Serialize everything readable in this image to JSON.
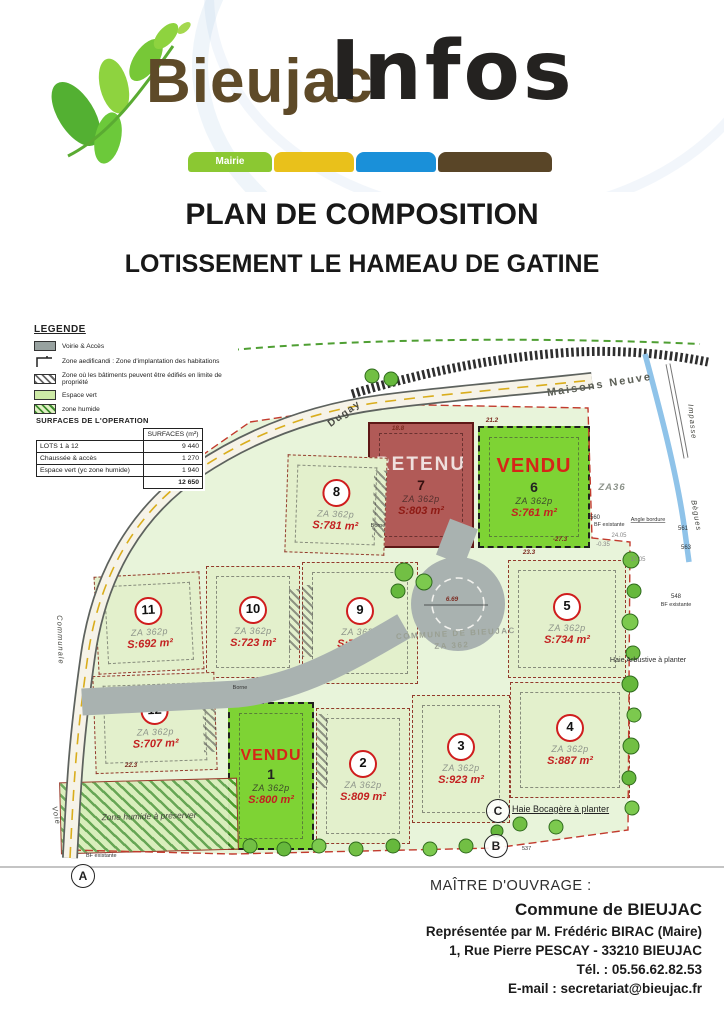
{
  "header": {
    "brand_primary": "Bieujac",
    "brand_secondary": "Infos",
    "ribbon": [
      {
        "label": "Mairie",
        "color": "#8bc832"
      },
      {
        "label": "",
        "color": "#e9c11b"
      },
      {
        "label": "",
        "color": "#1a90d9"
      },
      {
        "label": "",
        "color": "#594527"
      }
    ]
  },
  "titles": {
    "line1": "PLAN DE COMPOSITION",
    "line2": "LOTISSEMENT LE HAMEAU DE GATINE"
  },
  "legend": {
    "title": "LEGENDE",
    "items": [
      {
        "label": "Voirie & Accès"
      },
      {
        "label": "Zone aedificandi : Zone d'implantation des habitations"
      },
      {
        "label": "Zone où les bâtiments peuvent être édifiés en limite de propriété"
      },
      {
        "label": "Espace vert"
      },
      {
        "label": "zone humide"
      }
    ]
  },
  "surfaces": {
    "title": "SURFACES DE L'OPERATION",
    "col_header": "SURFACES (m²)",
    "rows": [
      {
        "label": "LOTS 1 à 12",
        "value": "9 440"
      },
      {
        "label": "Chaussée & accès",
        "value": "1 270"
      },
      {
        "label": "Espace vert (yc zone humide)",
        "value": "1 940"
      }
    ],
    "total": "12 650"
  },
  "plan": {
    "streets": {
      "dugay": "Dugay",
      "maisons_neuve": "Maisons Neuve",
      "impasse": "Impasse",
      "begues": "Bègues",
      "communale": "Communale",
      "voie": "Voie"
    },
    "labels": {
      "za36": "ZA36",
      "commune_line1": "COMMUNE DE BIEUJAC",
      "commune_line2": "ZA 362",
      "zone_humide": "Zone humide à préserver",
      "haie_bocagere": "Haie Bocagère à planter",
      "haie_arbustive": "Haie Arbustive à planter",
      "bf_existante": "BF existante",
      "angle_bordure": "Angle bordure",
      "borne": "Borne"
    },
    "markers": {
      "a": "A",
      "b": "B",
      "c": "C",
      "b_number": "537"
    },
    "dims": {
      "d1": "18.8",
      "d2": "21.2",
      "d3": "23.3",
      "d4": "-27.3",
      "d5": "-0.35",
      "d6": "24.05",
      "d7": "17.05",
      "d8": "6.69",
      "d9": "22.3",
      "d10": "560",
      "d11": "561",
      "d12": "563",
      "d13": "548"
    },
    "lots": [
      {
        "num": "1",
        "status": "VENDU",
        "parcel": "ZA 362p",
        "area": "S:800 m²"
      },
      {
        "num": "2",
        "parcel": "ZA 362p",
        "area": "S:809 m²"
      },
      {
        "num": "3",
        "parcel": "ZA 362p",
        "area": "S:923 m²"
      },
      {
        "num": "4",
        "parcel": "ZA 362p",
        "area": "S:887 m²"
      },
      {
        "num": "5",
        "parcel": "ZA 362p",
        "area": "S:734 m²"
      },
      {
        "num": "6",
        "status": "VENDU",
        "parcel": "ZA 362p",
        "area": "S:761 m²"
      },
      {
        "num": "7",
        "status": "RETENU",
        "parcel": "ZA 362p",
        "area": "S:803 m²"
      },
      {
        "num": "8",
        "parcel": "ZA 362p",
        "area": "S:781 m²"
      },
      {
        "num": "9",
        "parcel": "ZA 362p",
        "area": "S:709 m²"
      },
      {
        "num": "10",
        "parcel": "ZA 362p",
        "area": "S:723 m²"
      },
      {
        "num": "11",
        "parcel": "ZA 362p",
        "area": "S:692 m²"
      },
      {
        "num": "12",
        "parcel": "ZA 362p",
        "area": "S:707 m²"
      }
    ]
  },
  "footer": {
    "label": "MAÎTRE D'OUVRAGE :",
    "owner": "Commune de BIEUJAC",
    "lines": [
      "Représentée par M. Frédéric BIRAC (Maire)",
      "1, Rue Pierre PESCAY - 33210 BIEUJAC",
      "Tél. : 05.56.62.82.53",
      "E-mail : secretariat@bieujac.fr"
    ]
  }
}
